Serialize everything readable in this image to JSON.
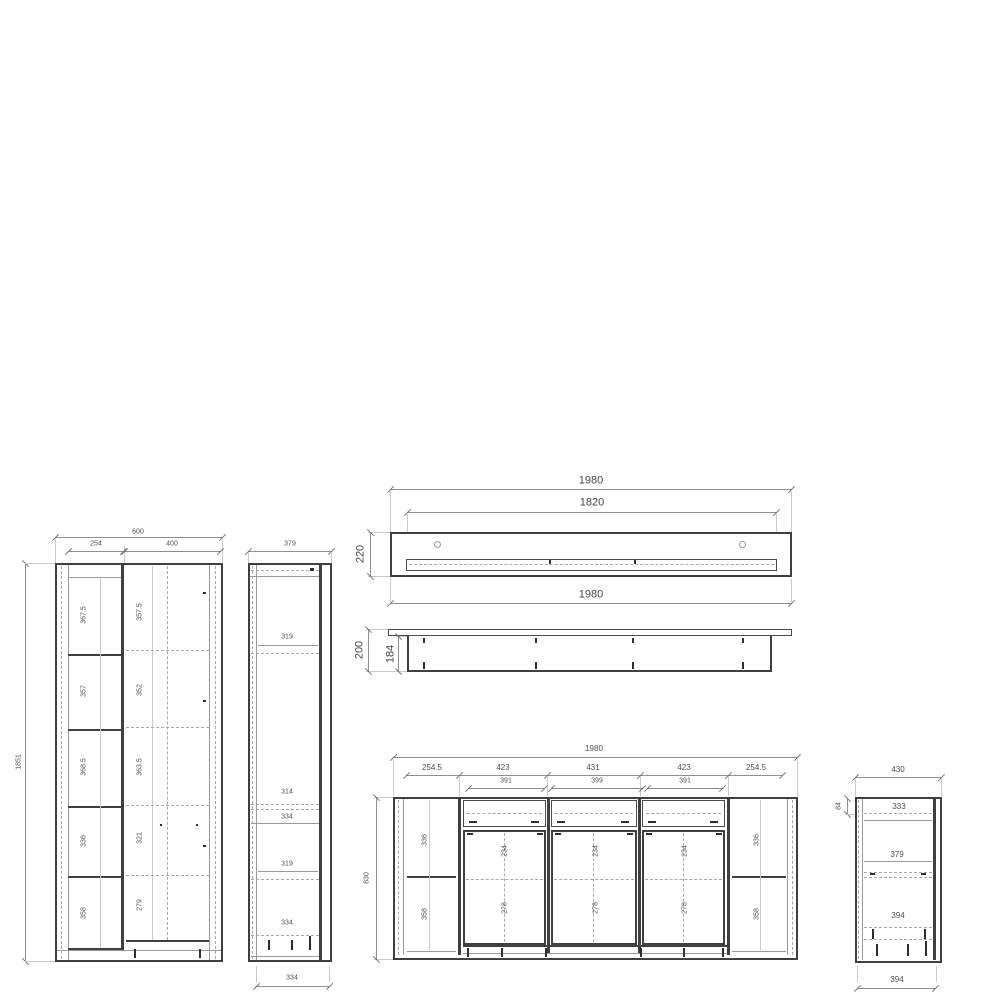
{
  "colors": {
    "background": "#ffffff",
    "outline": "#3f3f3f",
    "dimension_lines": "#8f8f8f",
    "text": "#4f4f4f"
  },
  "views": {
    "tall_cabinet_front": {
      "width_total": "600",
      "width_left": "254",
      "width_right": "400",
      "height_total": "1851",
      "left_sections": [
        "367.5",
        "357",
        "368.5",
        "336",
        "358"
      ],
      "right_sections": [
        "357.5",
        "352",
        "363.5",
        "321",
        "279"
      ]
    },
    "narrow_cabinet_side": {
      "width_top": "379",
      "sections": [
        "319",
        "314",
        "334",
        "319",
        "334"
      ],
      "width_bottom": "334"
    },
    "wall_shelf_front": {
      "width_total_top": "1980",
      "width_inner": "1820",
      "width_total_bottom": "1980",
      "height": "220"
    },
    "wall_shelf_side": {
      "depth_total": "200",
      "depth_inner": "184"
    },
    "sideboard_front": {
      "width_total": "1980",
      "top_segments": [
        "254.5",
        "423",
        "431",
        "423",
        "254.5"
      ],
      "inner_segments": [
        "391",
        "399",
        "391"
      ],
      "height_total": "830",
      "left_sections": [
        "336",
        "358"
      ],
      "right_sections": [
        "336",
        "358"
      ],
      "door_upper_sections": [
        "234",
        "234",
        "234"
      ],
      "door_lower_sections": [
        "278",
        "278",
        "278"
      ]
    },
    "sideboard_side": {
      "width_top": "430",
      "top_inset": "84",
      "sections": [
        "333",
        "379",
        "394"
      ],
      "width_bottom": "394"
    }
  }
}
